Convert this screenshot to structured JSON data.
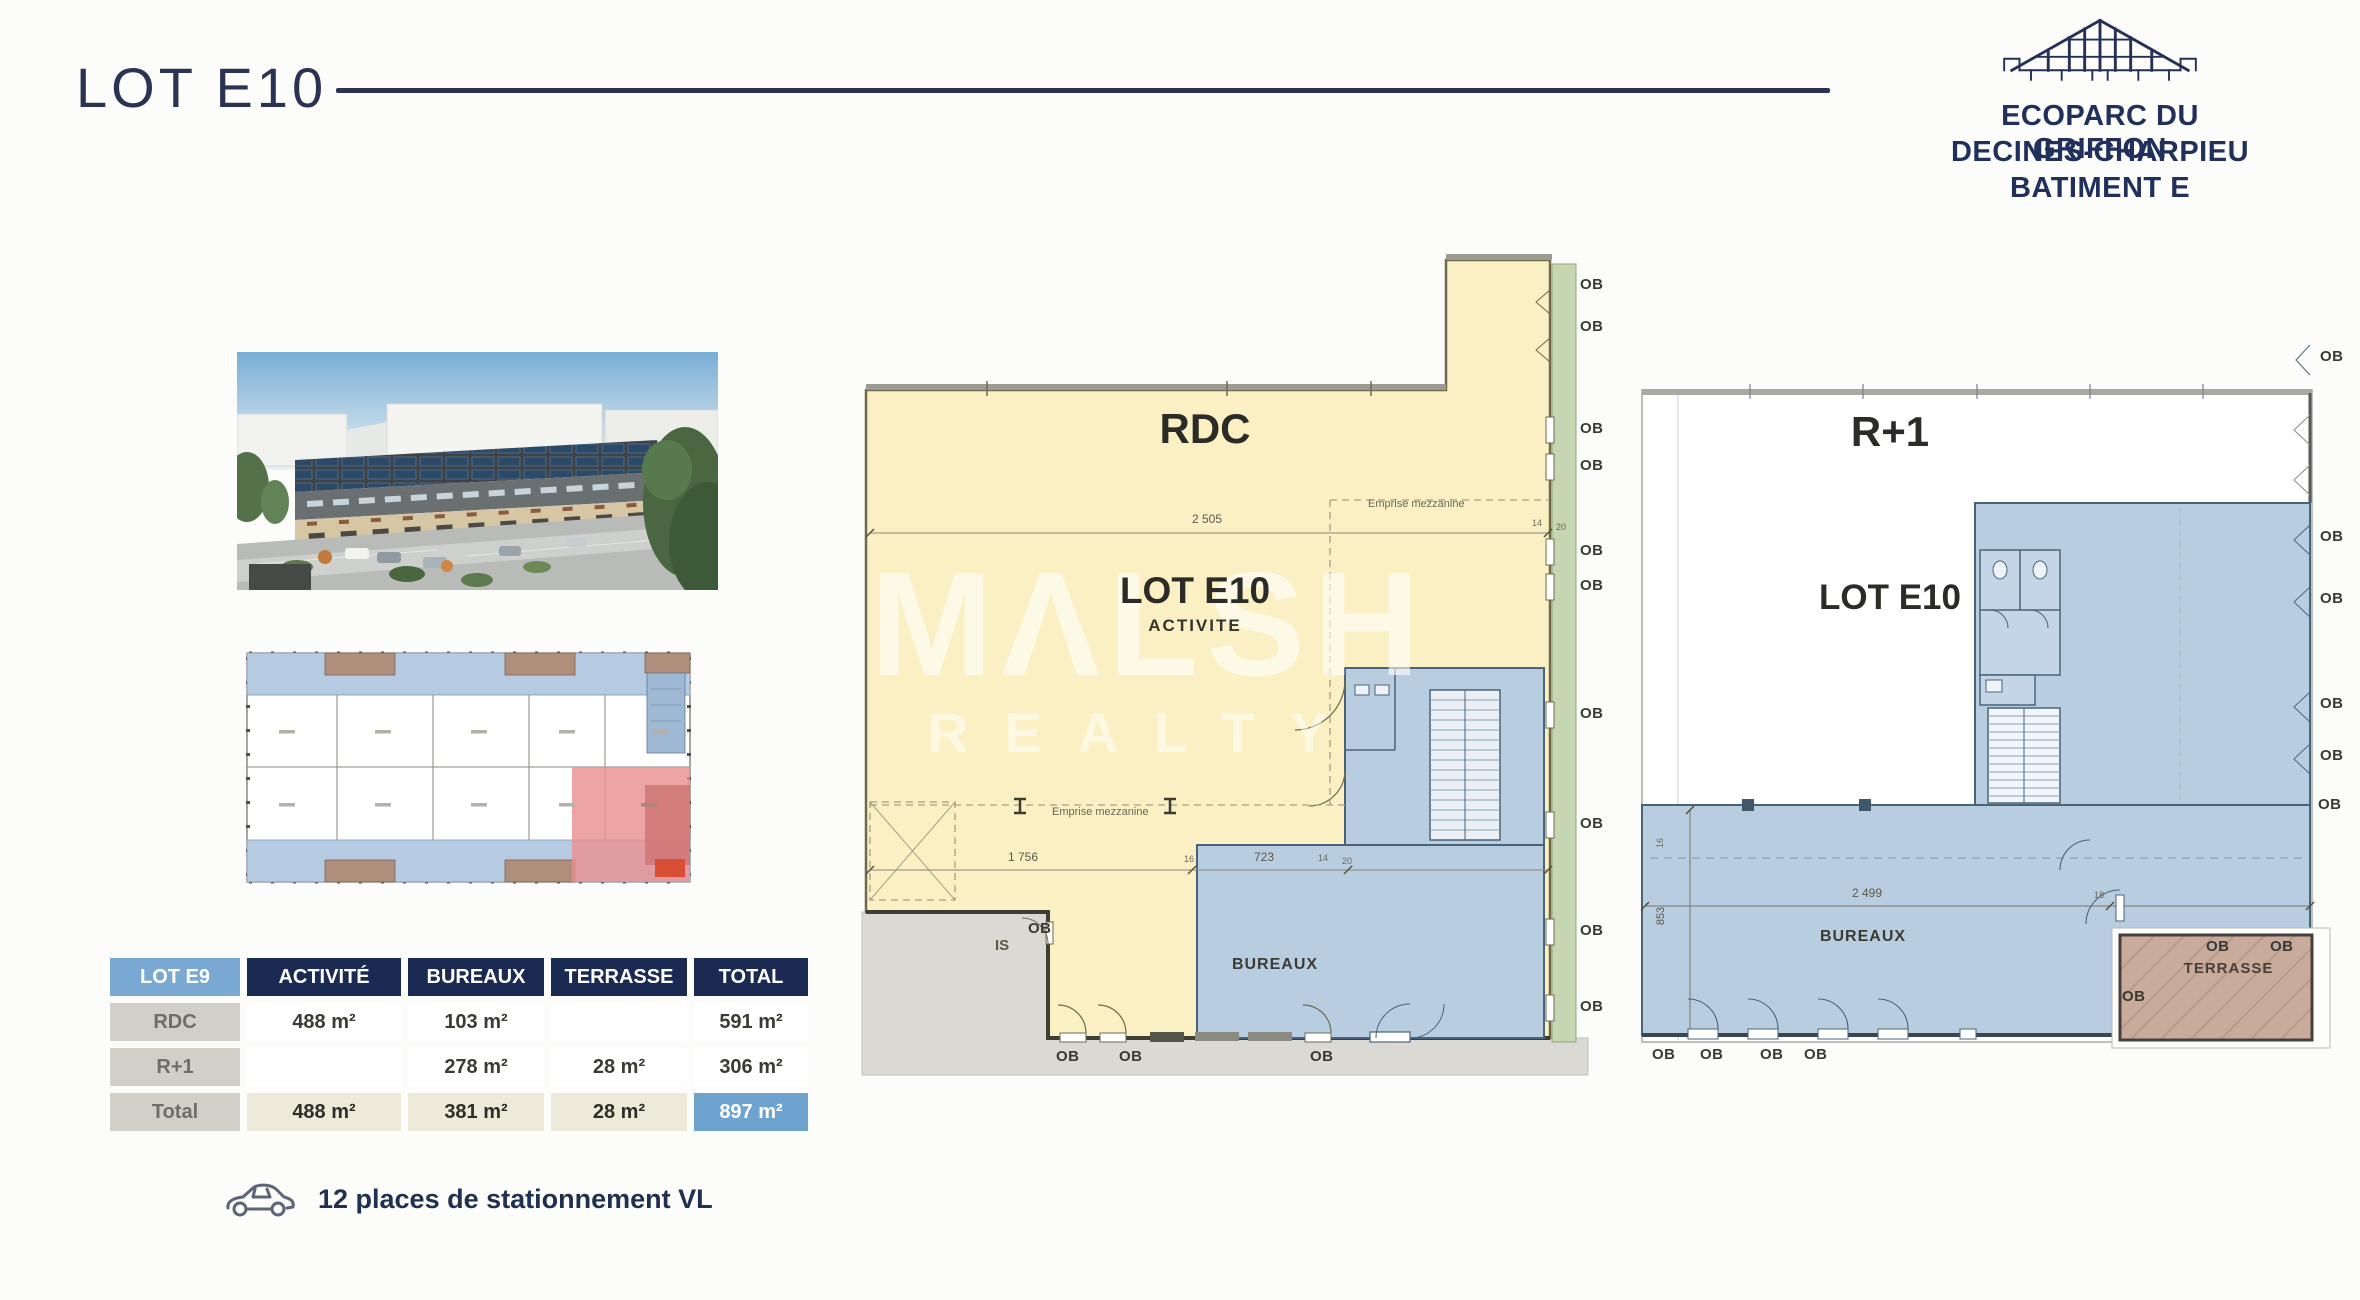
{
  "header": {
    "title": "LOT E10",
    "logo_line1": "ECOPARC DU GRIFFON",
    "logo_line2": "DECINES-CHARPIEU",
    "logo_line3": "BATIMENT E"
  },
  "surface_table": {
    "columns": [
      "LOT E9",
      "ACTIVITÉ",
      "BUREAUX",
      "TERRASSE",
      "TOTAL"
    ],
    "rows": [
      {
        "label": "RDC",
        "cells": [
          "488 m²",
          "103 m²",
          "",
          "591 m²"
        ]
      },
      {
        "label": "R+1",
        "cells": [
          "",
          "278 m²",
          "28 m²",
          "306 m²"
        ]
      },
      {
        "label": "Total",
        "cells": [
          "488 m²",
          "381 m²",
          "28 m²",
          "897 m²"
        ]
      }
    ]
  },
  "parking": {
    "text": "12 places de stationnement VL"
  },
  "watermark": {
    "line1": "MΛLSH",
    "line2": "REALTY"
  },
  "labels": {
    "ob": "OB",
    "is": "IS"
  },
  "rdc_plan": {
    "title": "RDC",
    "lot": "LOT E10",
    "subtitle": "ACTIVITE",
    "bureaux": "BUREAUX",
    "mezzanine": "Emprise mezzanine",
    "dim_top": "2 505",
    "dim_bottom_1": "1 756",
    "dim_bottom_2": "723",
    "dim_tick": "16",
    "dim_small_1": "14",
    "dim_small_2": "20"
  },
  "r1_plan": {
    "title": "R+1",
    "lot": "LOT E10",
    "bureaux": "BUREAUX",
    "terrasse": "TERRASSE",
    "dim_width": "2 499",
    "dim_height": "853",
    "dim_small_1": "18",
    "dim_small_2": "16"
  }
}
